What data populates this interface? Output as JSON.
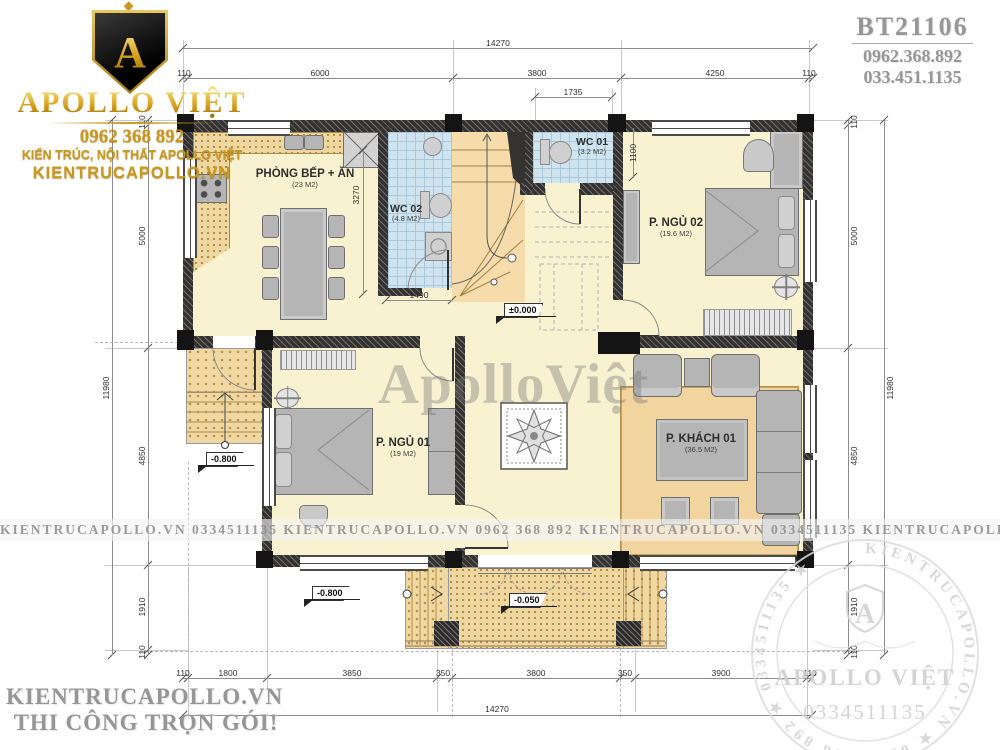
{
  "header": {
    "plan_code": "BT21106",
    "phone_1": "0962.368.892",
    "phone_2": "033.451.1135"
  },
  "logo": {
    "monogram": "A",
    "brand": "APOLLO VIỆT",
    "phone": "0962 368 892",
    "tagline": "KIẾN TRÚC, NỘI THẤT APOLLO VIỆT",
    "website": "KIENTRUCAPOLLO.VN"
  },
  "footer": {
    "website": "KIENTRUCAPOLLO.VN",
    "slogan": "THI CÔNG TRỌN GÓI!"
  },
  "watermarks": {
    "center": "ApolloViệt",
    "band": "KIENTRUCAPOLLO.VN    0334511135    KIENTRUCAPOLLO.VN    0962 368 892    KIENTRUCAPOLLO.VN    0334511135    KIENTRUCAPOLLO.VN",
    "seal_ring": "KIENTRUCAPOLLO.VN ★ 0962 368 892 ★ 0334511135 ★",
    "seal_monogram": "A",
    "seal_brand": "APOLLO VIỆT",
    "seal_phone": "0334511135"
  },
  "rooms": {
    "kitchen": {
      "name": "PHÒNG BẾP + ĂN",
      "area": "(23 M2)"
    },
    "wc02": {
      "name": "WC 02",
      "area": "(4.8 M2)"
    },
    "wc01": {
      "name": "WC 01",
      "area": "(3.2 M2)"
    },
    "bedroom2": {
      "name": "P. NGỦ 02",
      "area": "(19.6 M2)"
    },
    "bedroom1": {
      "name": "P. NGỦ 01",
      "area": "(19 M2)"
    },
    "living": {
      "name": "P. KHÁCH 01",
      "area": "(36.5 M2)"
    }
  },
  "levels": {
    "main": "±0.000",
    "porch": "-0.050",
    "yard": "-0.800"
  },
  "dims": {
    "top_total": "14270",
    "top": [
      "110",
      "6000",
      "3800",
      "4250",
      "110"
    ],
    "top_sub": "1735",
    "bottom": [
      "110",
      "1800",
      "3850",
      "350",
      "3800",
      "350",
      "3900",
      "110"
    ],
    "bottom_total": "14270",
    "left": [
      "110",
      "5000",
      "4850",
      "1910",
      "110"
    ],
    "left_total": "11980",
    "right": [
      "110",
      "5000",
      "4850",
      "1910",
      "110"
    ],
    "right_total": "11980",
    "kitchen_depth": "3270",
    "wc02_width": "1490",
    "bed2_offset": "1100"
  }
}
